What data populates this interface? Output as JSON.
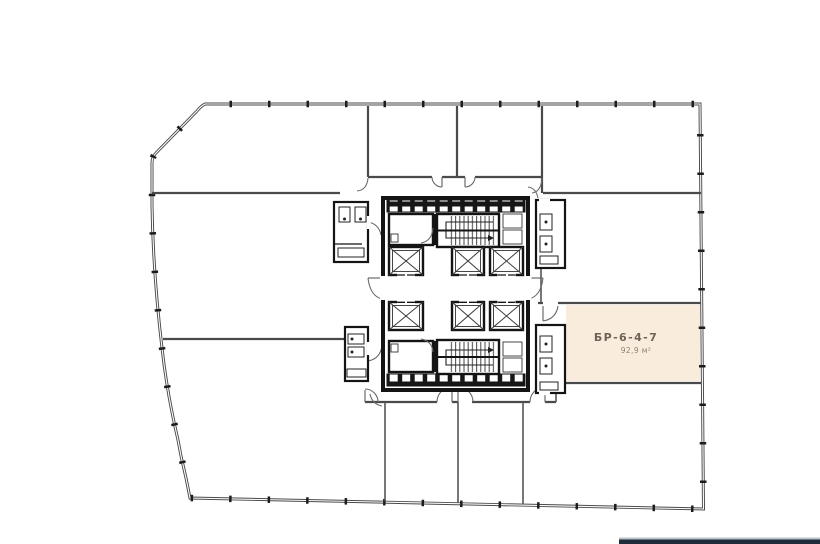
{
  "unit": {
    "label": "БР-6-4-7",
    "area": "92,9 м²"
  },
  "colors": {
    "background": "#ffffff",
    "exterior_wall": "#4a4a4a",
    "core_wall": "#141414",
    "unit_fill": "#f9ecdd",
    "unit_label_text": "#6f6358",
    "unit_area_text": "#8d8176",
    "footer_bar": "#1e2c3a",
    "footer_bar_highlight": "#b9c2c9"
  }
}
